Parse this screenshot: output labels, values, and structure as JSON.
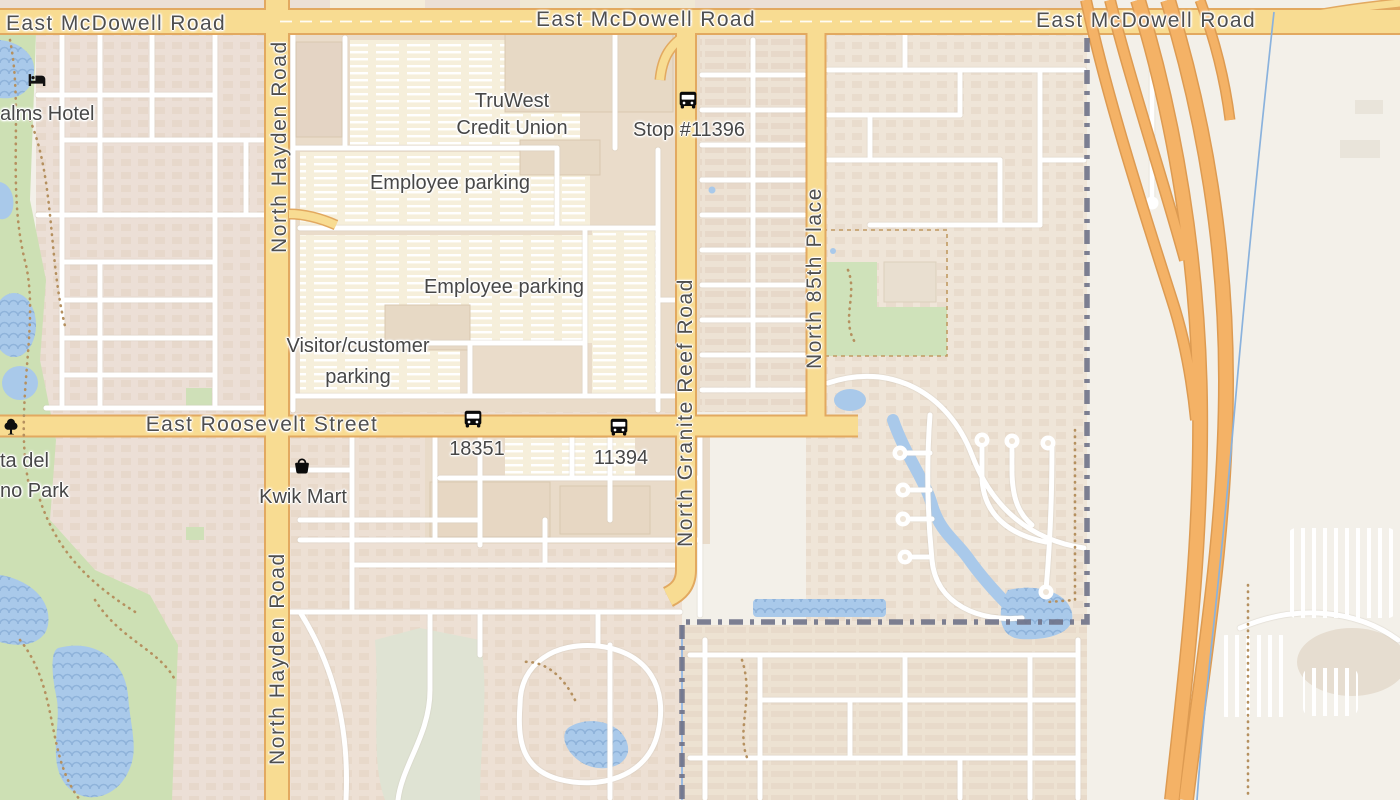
{
  "map": {
    "road_labels": {
      "mcdowell_west": "East McDowell Road",
      "mcdowell_center": "East McDowell Road",
      "mcdowell_east": "East McDowell Road",
      "hayden_north": "North Hayden Road",
      "hayden_south": "North Hayden Road",
      "roosevelt": "East Roosevelt Street",
      "granite_reef": "North Granite Reef Road",
      "eighty_fifth_place": "North 85th Place"
    },
    "places": {
      "hotel": "alms Hotel",
      "truwest_line1": "TruWest",
      "truwest_line2": "Credit Union",
      "employee_parking_north": "Employee parking",
      "employee_parking_south": "Employee parking",
      "visitor_parking_line1": "Visitor/customer",
      "visitor_parking_line2": "parking",
      "kwik_mart": "Kwik Mart",
      "park_line1": "ta del",
      "park_line2": "no Park"
    },
    "transit_stops": {
      "stop_11396": "Stop #11396",
      "stop_18351": "18351",
      "stop_11394": "11394"
    },
    "colors": {
      "background": "#f3f0e9",
      "residential": "#ecdfd4",
      "campus": "#eadcca",
      "parking_lot": "#f6efdb",
      "building": "#e6d8c4",
      "park_green": "#cde0b4",
      "golf_green": "#dfe3d3",
      "water": "#a9c9ea",
      "road_fill": "#f8dc92",
      "road_casing": "#e2a960",
      "motorway_fill": "#f4b266",
      "motorway_casing": "#dd9b52",
      "minor_road": "#ffffff",
      "boundary": "#6f7288",
      "trail": "#b5905f",
      "label_text": "#4d4d4d"
    }
  }
}
